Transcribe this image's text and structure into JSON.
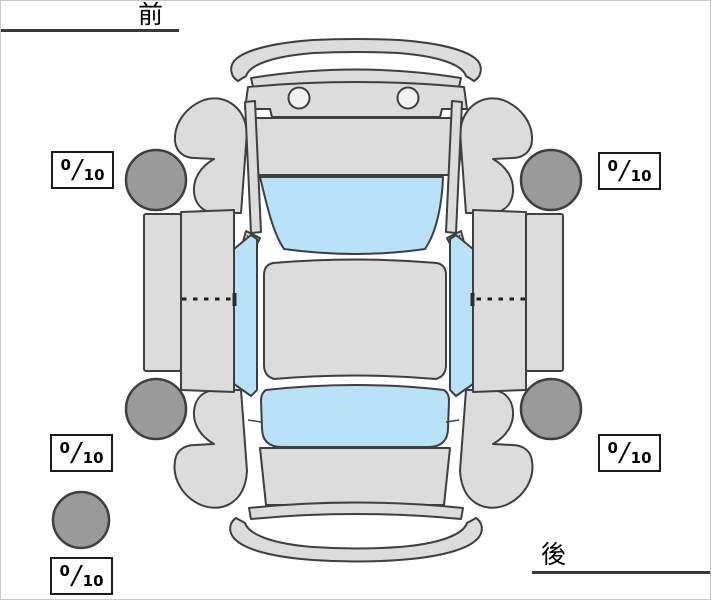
{
  "orientation": {
    "front_label": "前",
    "rear_label": "後"
  },
  "tires": {
    "front_left": {
      "score": "0",
      "slash": "/",
      "denominator": "10"
    },
    "front_right": {
      "score": "0",
      "slash": "/",
      "denominator": "10"
    },
    "rear_left": {
      "score": "0",
      "slash": "/",
      "denominator": "10"
    },
    "rear_right": {
      "score": "0",
      "slash": "/",
      "denominator": "10"
    },
    "spare": {
      "score": "0",
      "slash": "/",
      "denominator": "10"
    }
  },
  "colors": {
    "bg": "#ffffff",
    "body": "#dcdcdc",
    "line": "#3f3f3f",
    "glass": "#b9e1f7",
    "tire": "#9a9a9a",
    "score_border": "#1a1a1a"
  }
}
